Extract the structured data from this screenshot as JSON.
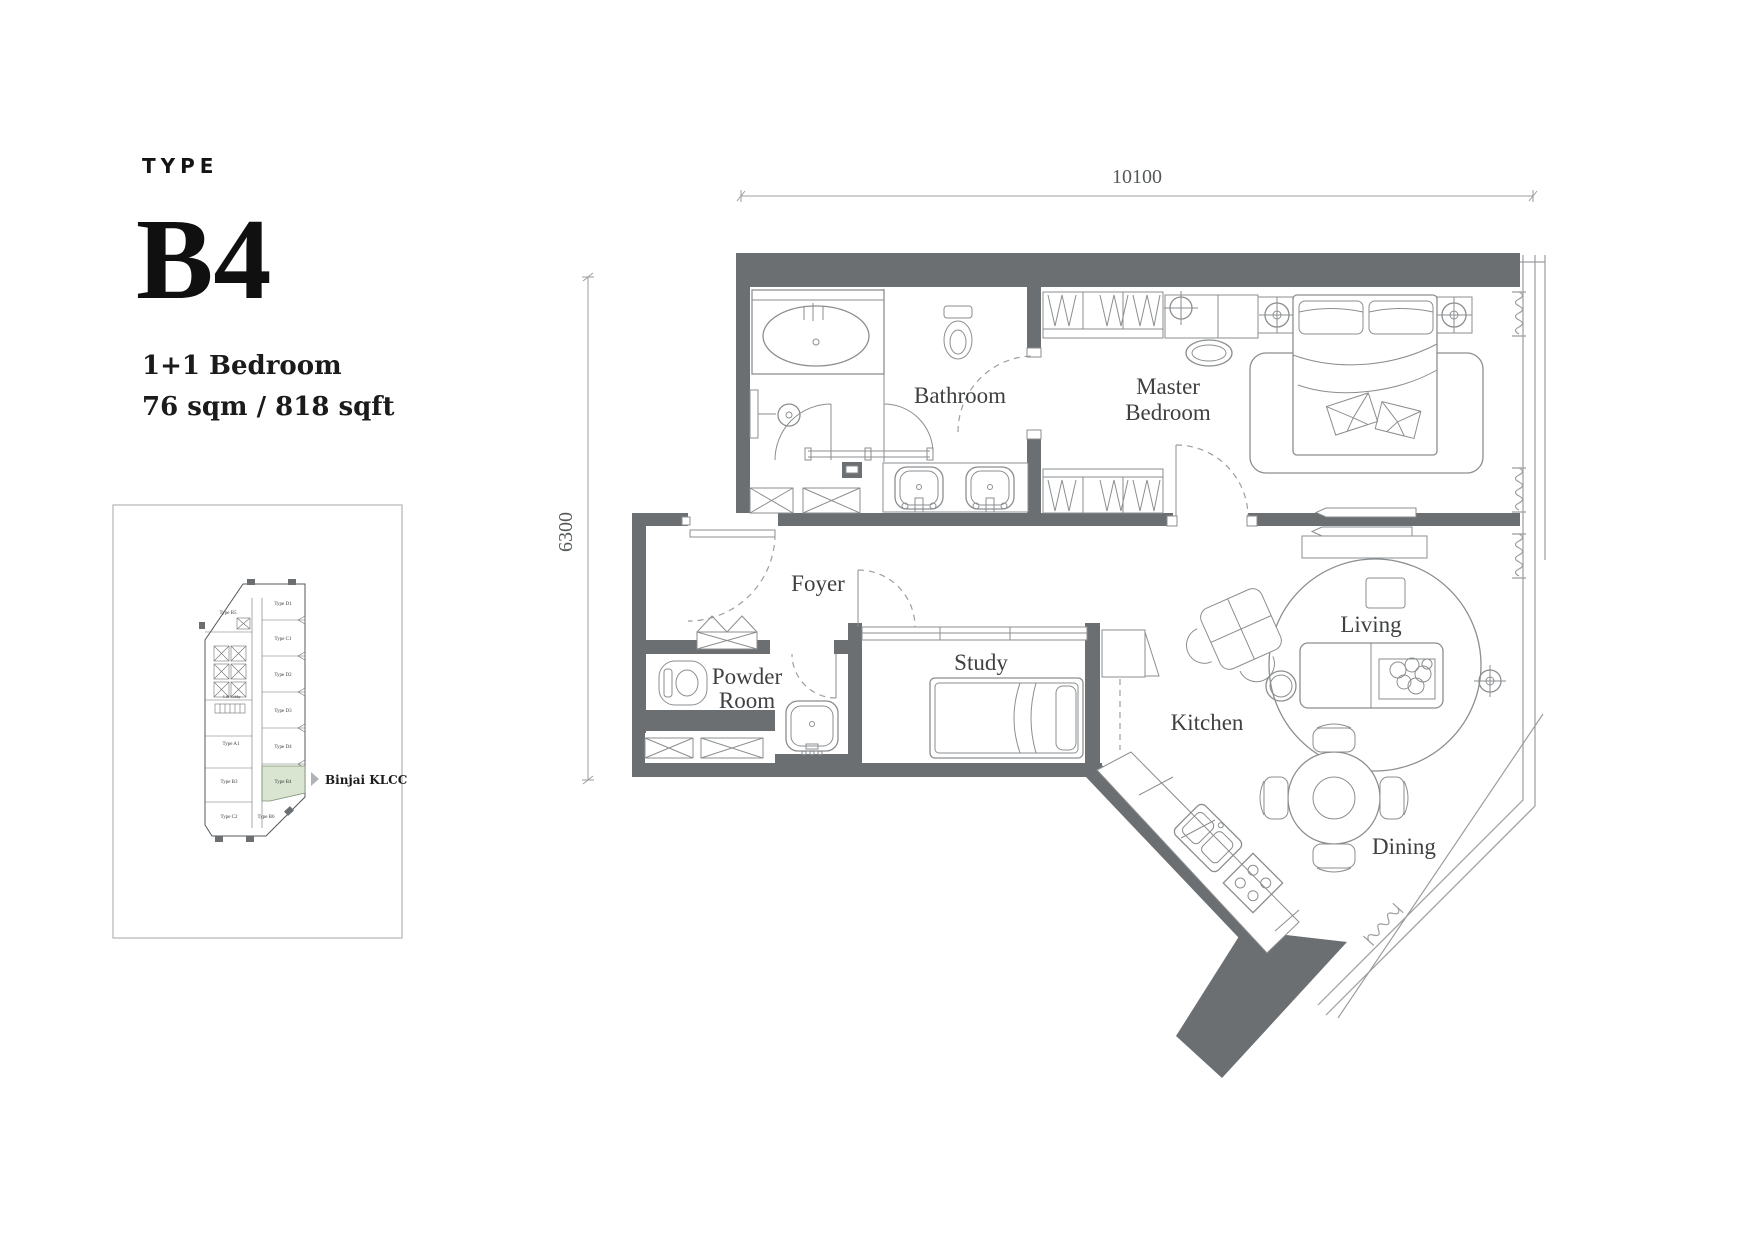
{
  "colors": {
    "wall_gray": "#6b6f72",
    "furniture_line": "#8b8e90",
    "window_line": "#9a9da0",
    "label_text": "#3e4042",
    "heading_text": "#101010",
    "highlight_green": "#d9e5d1"
  },
  "title_block": {
    "eyebrow": "TYPE",
    "unit_type": "B4",
    "config": "1+1 Bedroom",
    "area": "76 sqm / 818 sqft"
  },
  "key_plan": {
    "project": "Binjai KLCC",
    "highlighted_unit": "Type B4",
    "units": {
      "b5": "Type B5",
      "d1": "Type D1",
      "c1": "Type C1",
      "d2": "Type D2",
      "d3": "Type D3",
      "d4": "Type D4",
      "a1": "Type A1",
      "b3": "Type B3",
      "b4": "Type B4",
      "c2": "Type C2",
      "b6": "Type B6",
      "core": "Lift Lobby"
    }
  },
  "dimensions": {
    "width": "10100",
    "depth": "6300"
  },
  "rooms": {
    "bathroom": "Bathroom",
    "master_line1": "Master",
    "master_line2": "Bedroom",
    "foyer": "Foyer",
    "powder_line1": "Powder",
    "powder_line2": "Room",
    "study": "Study",
    "kitchen": "Kitchen",
    "living": "Living",
    "dining": "Dining"
  }
}
